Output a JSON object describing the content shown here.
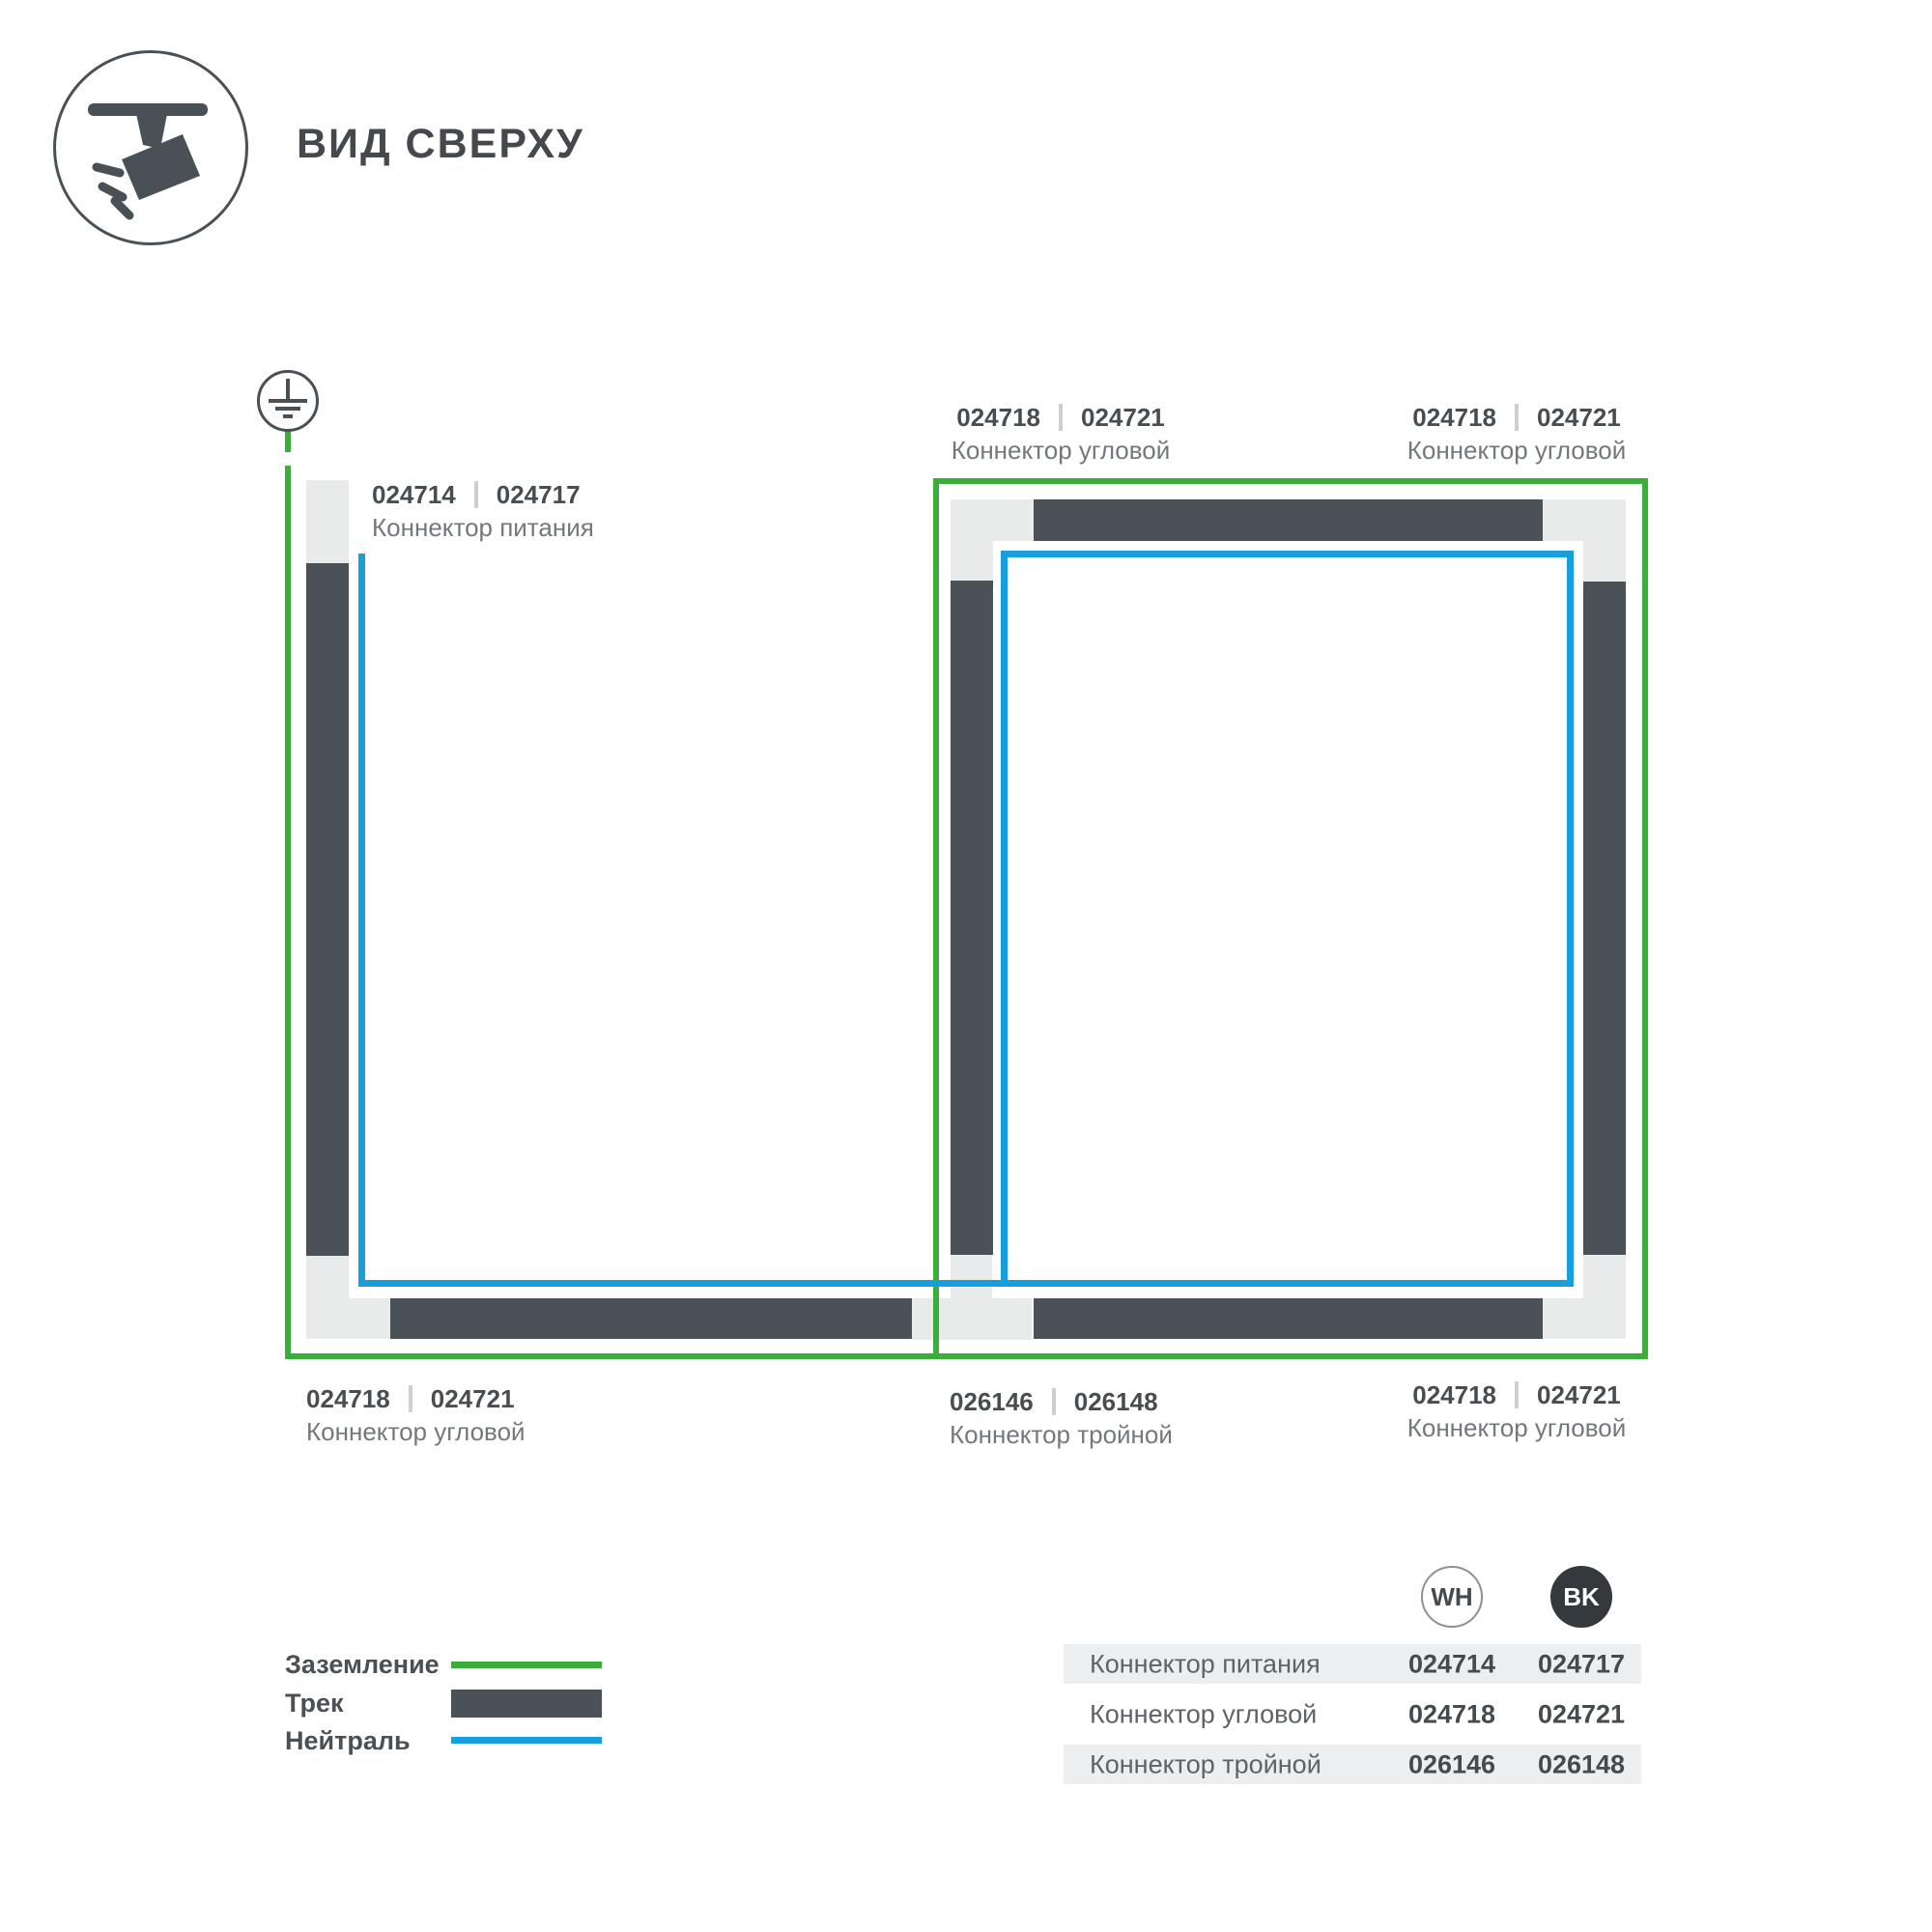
{
  "header": {
    "title": "ВИД СВЕРХУ",
    "icon": "track-spotlight"
  },
  "colors": {
    "ground_green": "#3aad3b",
    "neutral_blue": "#189fdb",
    "track_dark": "#4b5257",
    "connector_gray": "#e9ebeb"
  },
  "diagram": {
    "ground_symbol": "earth-ground",
    "labels": {
      "power": {
        "codes": [
          "024714",
          "024717"
        ],
        "caption": "Коннектор питания"
      },
      "corner_top_left": {
        "codes": [
          "024718",
          "024721"
        ],
        "caption": "Коннектор угловой"
      },
      "corner_top_right": {
        "codes": [
          "024718",
          "024721"
        ],
        "caption": "Коннектор угловой"
      },
      "corner_bottom_left": {
        "codes": [
          "024718",
          "024721"
        ],
        "caption": "Коннектор угловой"
      },
      "triple_bottom_center": {
        "codes": [
          "026146",
          "026148"
        ],
        "caption": "Коннектор тройной"
      },
      "corner_bottom_right": {
        "codes": [
          "024718",
          "024721"
        ],
        "caption": "Коннектор угловой"
      }
    }
  },
  "legend": {
    "items": [
      {
        "label": "Заземление",
        "swatch": "green-line"
      },
      {
        "label": "Трек",
        "swatch": "dark-bar"
      },
      {
        "label": "Нейтраль",
        "swatch": "blue-line"
      }
    ]
  },
  "table": {
    "columns": [
      {
        "code": "WH"
      },
      {
        "code": "BK"
      }
    ],
    "rows": [
      {
        "label": "Коннектор питания",
        "wh": "024714",
        "bk": "024717"
      },
      {
        "label": "Коннектор угловой",
        "wh": "024718",
        "bk": "024721"
      },
      {
        "label": "Коннектор тройной",
        "wh": "026146",
        "bk": "026148"
      }
    ]
  }
}
